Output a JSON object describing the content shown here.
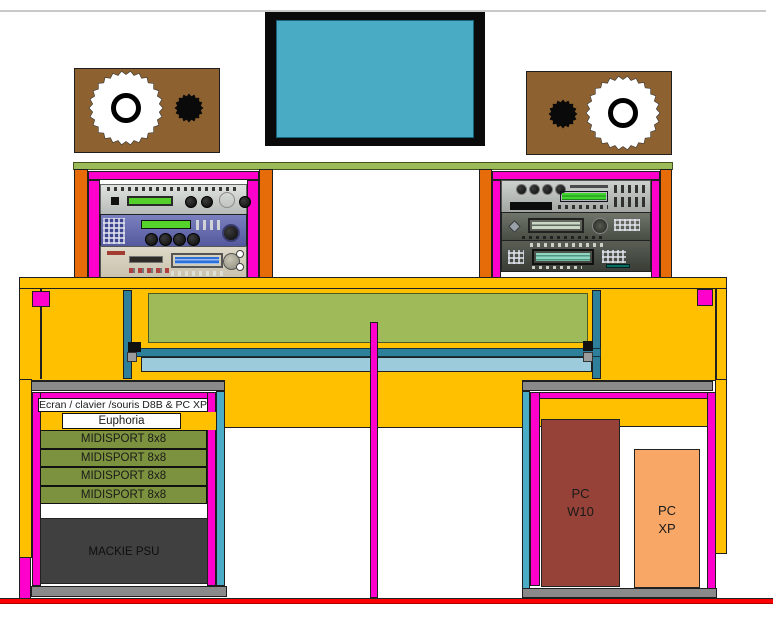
{
  "palette": {
    "desk_yellow": "#FFC000",
    "magenta": "#FF00CC",
    "orange": "#E66C0A",
    "teal_dark": "#2E7F99",
    "teal_light": "#4BACC6",
    "tray_blue": "#9CCCDB",
    "panel_green": "#9FBA59",
    "shelf_green": "#9BBB59",
    "speaker_brown": "#8D6230",
    "monitor_blue": "#4AACC4",
    "pc_w10_red": "#964238",
    "pc_xp_orange": "#F8A766",
    "midisport_green": "#7C923E",
    "psu_gray": "#404040",
    "bar_gray": "#8A8A8A",
    "baseline_red": "#FF0000"
  },
  "left_bay": {
    "shelf_label": "Ecran / clavier /souris D8B & PC XP",
    "euphoria_label": "Euphoria",
    "midisport_units": [
      "MIDISPORT 8x8",
      "MIDISPORT 8x8",
      "MIDISPORT 8x8",
      "MIDISPORT 8x8"
    ],
    "psu_label": "MACKIE PSU"
  },
  "right_bay": {
    "pc_w10": {
      "line1": "PC",
      "line2": "W10"
    },
    "pc_xp": {
      "line1": "PC",
      "line2": "XP"
    }
  }
}
